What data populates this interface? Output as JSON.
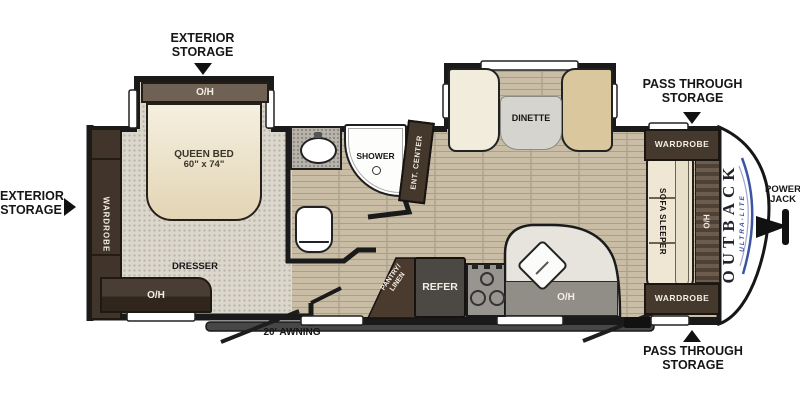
{
  "title": "Outback Ultra-Lite travel trailer floor plan",
  "exterior": {
    "storage_top": [
      "EXTERIOR",
      "STORAGE"
    ],
    "storage_left": [
      "EXTERIOR",
      "STORAGE"
    ],
    "pass_through_top": [
      "PASS THROUGH",
      "STORAGE"
    ],
    "pass_through_bottom": [
      "PASS THROUGH",
      "STORAGE"
    ],
    "power_jack": [
      "POWER",
      "JACK"
    ],
    "awning": "20' AWNING"
  },
  "bedroom": {
    "slideout_oh": "O/H",
    "bed": "QUEEN BED",
    "bed_size": "60\" x 74\"",
    "wardrobe": "WARDROBE",
    "dresser": "DRESSER",
    "dresser_oh": "O/H"
  },
  "bath": {
    "shower": "SHOWER",
    "ent_center": "ENT. CENTER"
  },
  "kitchen": {
    "dinette": "DINETTE",
    "pantry_line1": "PANTRY/",
    "pantry_line2": "LINEN",
    "refer": "REFER",
    "oh": "O/H"
  },
  "living": {
    "sofa": "SOFA SLEEPER",
    "oh": "O/H",
    "wardrobe_top": "WARDROBE",
    "wardrobe_bottom": "WARDROBE"
  },
  "brand": {
    "name": "OUTBACK",
    "sub": "ULTRA-LITE"
  },
  "colors": {
    "wall": "#1a1a1a",
    "cabinet_brown": "#45382d",
    "overhead_taupe": "#6f6254",
    "carpet": "#dbd7cd",
    "plank_floor": "#c9bda6",
    "seat_cream": "#f2ecdc",
    "seat_tan": "#dbc79e",
    "counter_gray": "#918e88",
    "refer_gray": "#4c4844",
    "brand_blue": "#3b5099"
  }
}
